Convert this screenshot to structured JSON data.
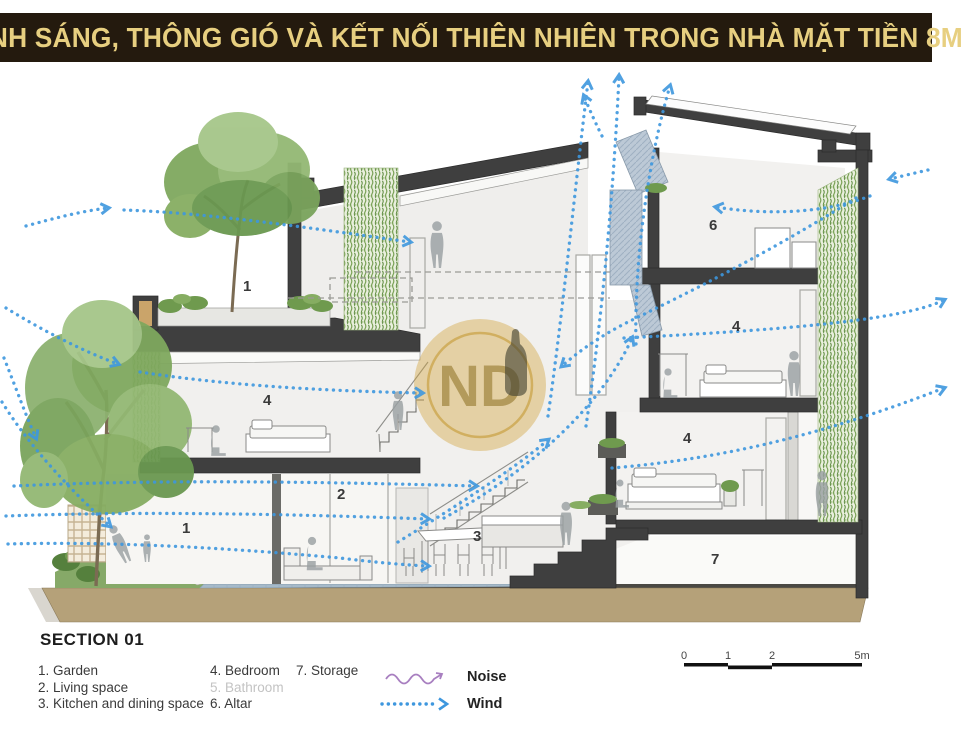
{
  "title": "ÁNH SÁNG, THÔNG GIÓ VÀ KẾT NỐI THIÊN NHIÊN TRONG NHÀ MẶT TIỀN 8M",
  "watermark": "ND",
  "section": {
    "heading": "SECTION 01",
    "items": [
      {
        "num": "1.",
        "label": "Garden"
      },
      {
        "num": "2.",
        "label": "Living space"
      },
      {
        "num": "3.",
        "label": "Kitchen and dining space"
      },
      {
        "num": "4.",
        "label": "Bedroom"
      },
      {
        "num": "5.",
        "label": "Bathroom"
      },
      {
        "num": "6.",
        "label": "Altar"
      },
      {
        "num": "7.",
        "label": "Storage"
      }
    ]
  },
  "symbols": {
    "noise": "Noise",
    "wind": "Wind"
  },
  "scale_bar": {
    "t0": "0",
    "t1": "1",
    "t2": "2",
    "t3": "5m"
  },
  "plan_labels": {
    "garden_roof": "1",
    "garden": "1",
    "living": "2",
    "kitchen": "3",
    "bedroom_left": "4",
    "bedroom_top": "4",
    "bedroom_mid": "4",
    "altar": "6",
    "storage": "7"
  },
  "colors": {
    "banner_bg": "#241a0e",
    "banner_text": "#e7cf80",
    "wind_blue": "#3e97de",
    "noise_purple": "#a87fc0",
    "structure_dark": "#3f3f3f",
    "earth_tan": "#b5a179",
    "greenery": "#7fa85e",
    "tile_blue": "#a6bac9",
    "watermark_gold": "#d2a53e"
  }
}
